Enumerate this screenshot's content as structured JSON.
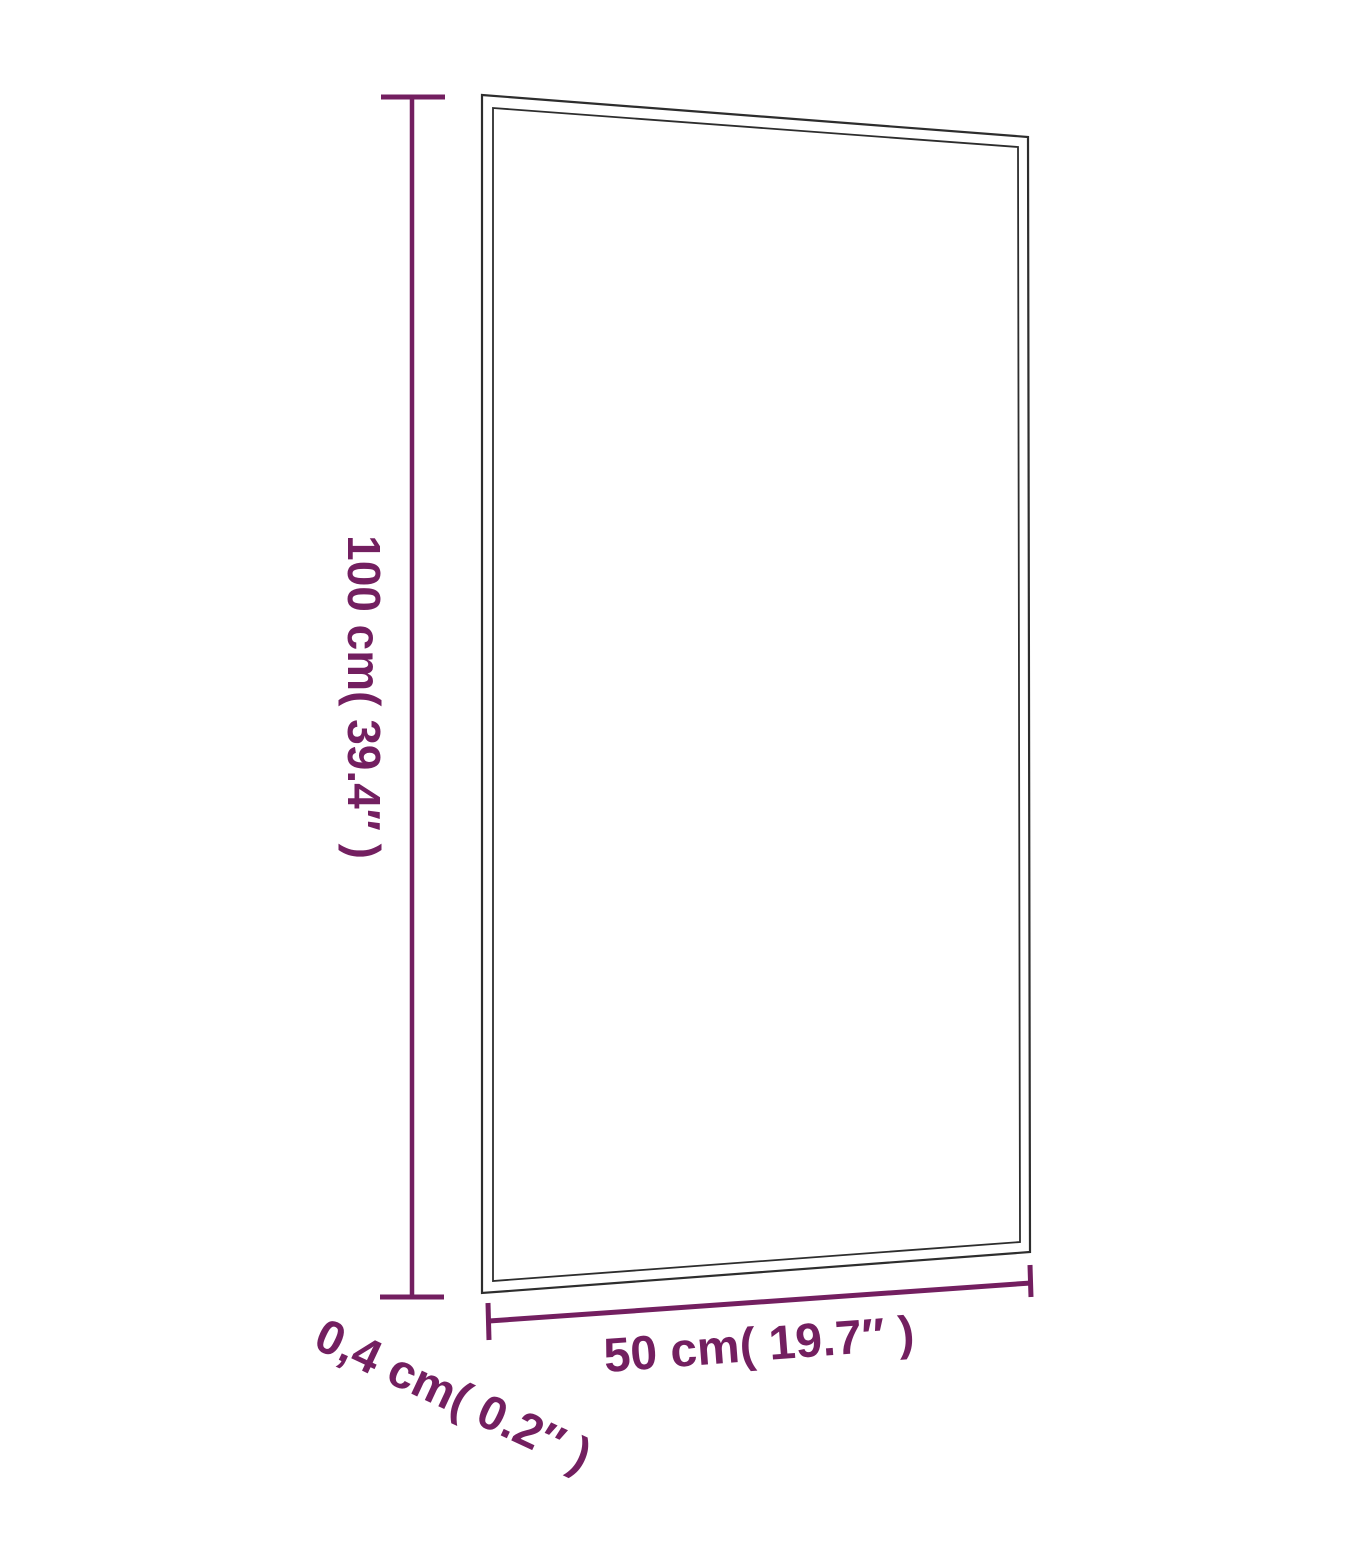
{
  "diagram": {
    "kind": "product-dimension-diagram",
    "subject": "rectangular glass panel shown in slight perspective with double outline",
    "colors": {
      "dimension_accent": "#731f60",
      "panel_outline": "#2d2d2d",
      "background": "#ffffff"
    },
    "labels": {
      "height": "100 cm( 39.4″ )",
      "width": "50 cm( 19.7″ )",
      "depth": "0,4 cm( 0.2″ )"
    }
  }
}
